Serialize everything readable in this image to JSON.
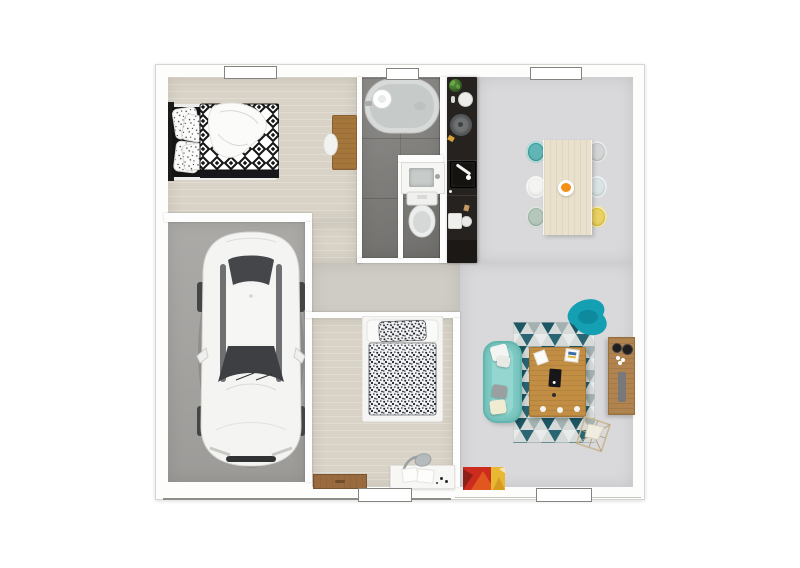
{
  "scene": {
    "description": "3D top-down floor plan render of a single-storey house with garage",
    "background": "#ffffff"
  },
  "palette": {
    "wall": "#fdfdfd",
    "wall_outline": "#d6d5d2",
    "wood_floor": "#d9d3c7",
    "hall_floor": "#cfccc5",
    "garage_floor": "#a7a5a2",
    "tile_floor": "#82817e",
    "living_floor": "#d9d9db",
    "kitchen_counter": "#26221f",
    "sofa": "#7ecdc6",
    "armchair": "#149fb3",
    "rug_dark": "#1d5763",
    "rug_mid": "#a3b2b1",
    "rug_light": "#d6dbd9",
    "coffee_table": "#c28e44",
    "tv_cabinet": "#b1834e",
    "dining_table": "#eae1cc",
    "desk_wood": "#a5763c",
    "bench_wood": "#9a6b3f",
    "white_desk": "#f7f7f5",
    "car_body": "#f4f4f2",
    "glass": "#44464a",
    "bathtub": "#d7dad9",
    "painting_red": "#cc2c1e",
    "painting_orange": "#e2571f",
    "painting_yellow": "#e8b832",
    "fruit": "#f29018",
    "chairs": [
      "#2d9d9d",
      "#f0f0ee",
      "#9db5a3",
      "#c5c8c8",
      "#cedbdc",
      "#e2c32f"
    ]
  },
  "rooms": [
    {
      "id": "bedroom-1",
      "furniture": [
        "double-bed-bw-diamond-duvet",
        "wood-desk",
        "white-chair"
      ],
      "windows": 1
    },
    {
      "id": "bathroom",
      "furniture": [
        "bathtub",
        "sink-vanity",
        "toilet"
      ],
      "windows": 1
    },
    {
      "id": "kitchen",
      "furniture": [
        "black-counter",
        "hob",
        "sink",
        "coffee-machine",
        "plant",
        "kettle"
      ],
      "windows": 0
    },
    {
      "id": "dining-area",
      "furniture": [
        "dining-table",
        "six-chairs",
        "fruit-plate"
      ],
      "windows": 1
    },
    {
      "id": "garage",
      "furniture": [
        "white-car"
      ],
      "windows": 0
    },
    {
      "id": "hallway",
      "furniture": [],
      "windows": 0
    },
    {
      "id": "bedroom-2",
      "furniture": [
        "single-bed-speckled-duvet",
        "wood-bench",
        "white-desk",
        "desk-lamp"
      ],
      "windows": 1
    },
    {
      "id": "living-room",
      "furniture": [
        "teal-sofa",
        "chevron-rug",
        "coffee-table",
        "teal-armchair",
        "tv-cabinet",
        "wire-basket",
        "abstract-painting"
      ],
      "windows": 1
    }
  ]
}
